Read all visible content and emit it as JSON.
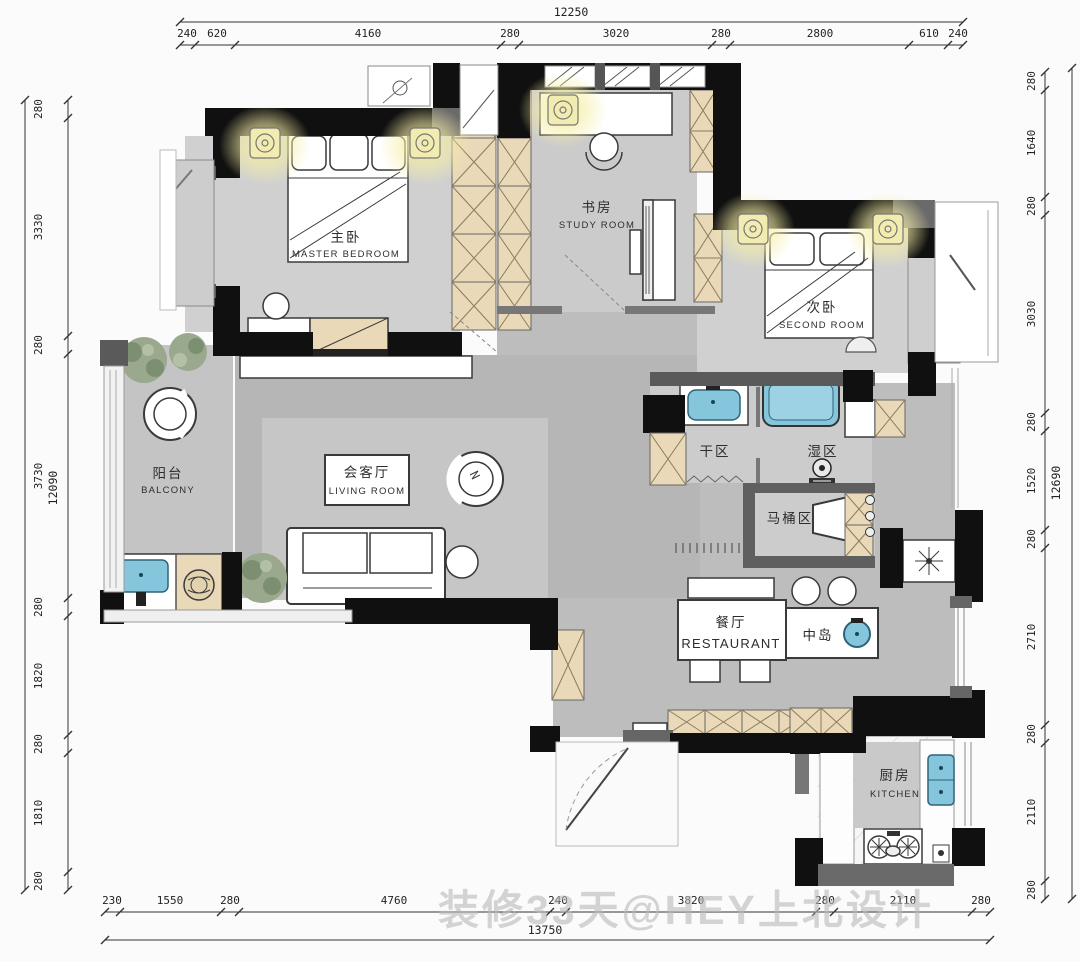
{
  "watermark": "装修33天@HEY上北设计",
  "dims": {
    "top": {
      "total": "12250",
      "segs": [
        "240",
        "620",
        "4160",
        "280",
        "3020",
        "280",
        "2800",
        "610",
        "240"
      ]
    },
    "left": {
      "total": "12090",
      "segs": [
        "280",
        "3330",
        "280",
        "3730",
        "280",
        "1820",
        "280",
        "1810",
        "280"
      ]
    },
    "right": {
      "total": "12690",
      "segs": [
        "280",
        "1640",
        "280",
        "3030",
        "280",
        "1520",
        "280",
        "2710",
        "280",
        "2110",
        "280"
      ]
    },
    "bottom": {
      "total": "13750",
      "segs": [
        "230",
        "1550",
        "280",
        "4760",
        "240",
        "3820",
        "280",
        "2110",
        "280"
      ]
    }
  },
  "rooms": {
    "master": {
      "zh": "主卧",
      "en": "MASTER BEDROOM"
    },
    "study": {
      "zh": "书房",
      "en": "STUDY ROOM"
    },
    "second": {
      "zh": "次卧",
      "en": "SECOND ROOM"
    },
    "balcony": {
      "zh": "阳台",
      "en": "BALCONY"
    },
    "living": {
      "zh": "会客厅",
      "en": "LIVING ROOM"
    },
    "dry": {
      "zh": "干区"
    },
    "wet": {
      "zh": "湿区"
    },
    "toilet": {
      "zh": "马桶区"
    },
    "dining": {
      "zh": "餐厅",
      "en": "RESTAURANT"
    },
    "island": {
      "zh": "中岛"
    },
    "kitchen": {
      "zh": "厨房",
      "en": "KITCHEN"
    }
  },
  "colors": {
    "wall": "#111111",
    "floor": "#bfbfbf",
    "cabinet": "#ead9b8",
    "fixture_blue": "#85c6dd",
    "glow": "#f5eea6"
  }
}
